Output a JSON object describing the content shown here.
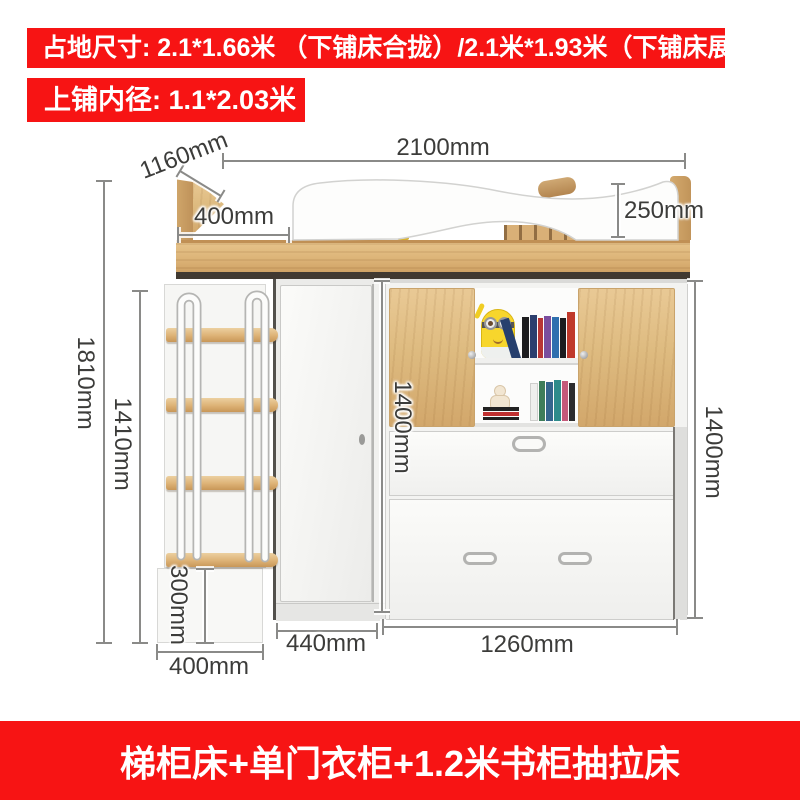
{
  "banner_top": {
    "text": "占地尺寸: 2.1*1.66米 （下铺床合拢）/2.1米*1.93米（下铺床展开）"
  },
  "banner_inner": {
    "text": "上铺内径: 1.1*2.03米"
  },
  "footer_banner": {
    "text": "梯柜床+单门衣柜+1.2米书柜抽拉床"
  },
  "dimensions": {
    "top_width": "2100mm",
    "depth": "1160mm",
    "headboard_gap": "400mm",
    "rail_height": "250mm",
    "overall_height": "1810mm",
    "ladder_height": "1410mm",
    "bottom_step_height": "300mm",
    "ladder_width": "400mm",
    "wardrobe_depth": "440mm",
    "pullout_bed_width": "1260mm",
    "cabinet_height_left": "1400mm",
    "cabinet_height_right": "1400mm"
  },
  "colors": {
    "banner_red": "#f71414",
    "wood": "#ddb57c",
    "white_panel": "#f6f6f4",
    "dimension_text": "#3c3c3a",
    "dimension_line": "#8a8a88"
  }
}
